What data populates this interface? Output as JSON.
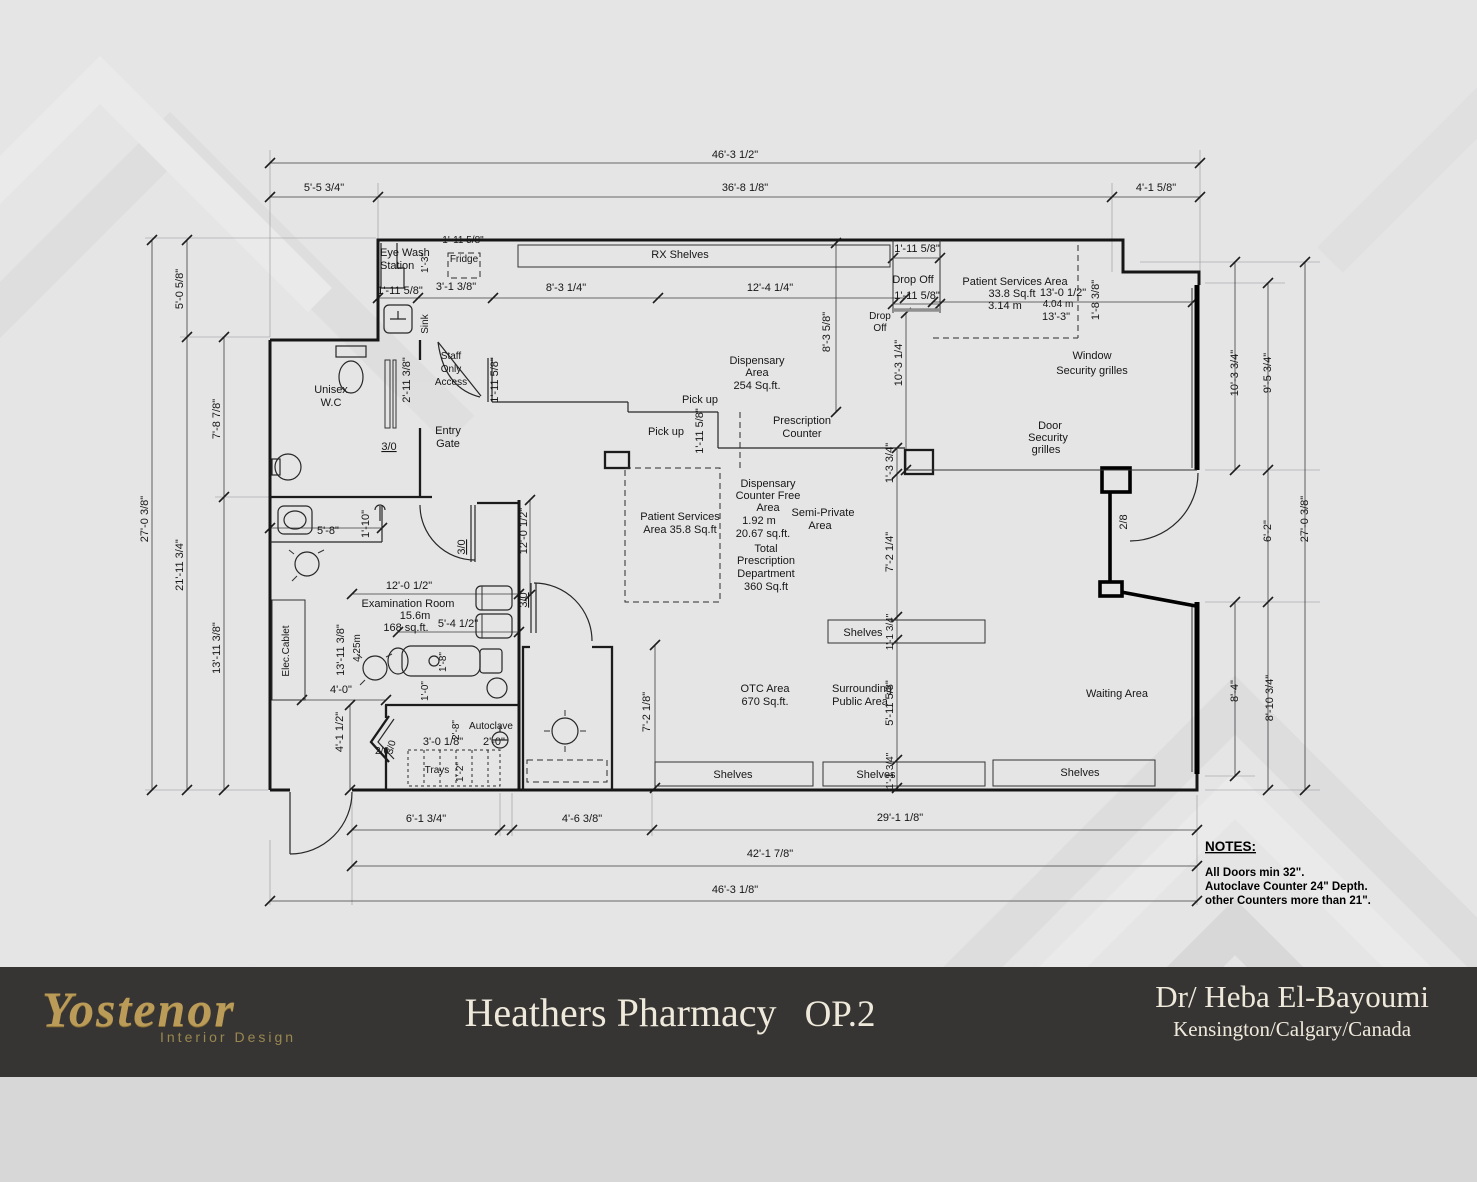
{
  "plan": {
    "dims": {
      "overall_top": "46'-3 1/2\"",
      "top_left": "5'-5 3/4\"",
      "top_mid": "36'-8 1/8\"",
      "top_right": "4'-1 5/8\"",
      "left_overall": "27'-0 3/8\"",
      "left_top": "5'-0 5/8\"",
      "left_mid": "21'-11 3/4\"",
      "wc_height": "7'-8 7/8\"",
      "exam_height": "13'-11 3/8\"",
      "exam_height_inner": "13'-11 3/8\"",
      "exam_height_m": "4.25m",
      "fridge_w": "1'-11 5/8\"",
      "eyewash_h": "1'-3\"",
      "row_a": "1'-11 5/8\"",
      "row_b": "3'-1 3/8\"",
      "row_c": "8'-3 1/4\"",
      "row_d": "12'-4 1/4\"",
      "wc_door_side": "2'-11 3/8\"",
      "staff_counter": "1'-11 5/8\"",
      "drop_w1": "1'-11 5/8\"",
      "drop_w2": "1'-11 5/8\"",
      "disp_depth": "8'-3 5/8\"",
      "mid_v": "10'-3 1/4\"",
      "ps_w": "13'-0 1/2\"",
      "ps_wm": "4.04 m",
      "ps_w2": "13'-3\"",
      "step_h": "1'-8 3/8\"",
      "pickup_w": "1'-11 5/8\"",
      "col_h": "1'-3 3/4\"",
      "semi_h": "7'-2 1/4\"",
      "win_h1": "10'-3 3/4\"",
      "win_h2": "9'-5 3/4\"",
      "right_overall": "27'-0 3/8\"",
      "door_h": "6'-2\"",
      "wait_h1": "8'-4\"",
      "wait_h2": "8'-10 3/4\"",
      "shelf_d1": "1'-1 3/4\"",
      "shelf_d2": "1'-1 3/4\"",
      "pub_h": "5'-11 5/8\"",
      "otc_v": "7'-2 1/8\"",
      "sink_w": "5'-8\"",
      "sink_d": "1'-10\"",
      "exam_w": "12'-0 1/2\"",
      "exam_w_v": "12'-0 1/2\"",
      "chair_w": "5'-4 1/2\"",
      "chair_d": "1'-8\"",
      "gap_1_0": "1'-0\"",
      "elec_w": "4'-0\"",
      "vest_h": "4'-1 1/2\"",
      "auto_d": "2'-8\"",
      "tray_w": "3'-0 1/8\"",
      "auto_w": "2'-0\"",
      "tray_d": "1'-2\"",
      "bot_a": "6'-1 3/4\"",
      "bot_b": "4'-6 3/8\"",
      "bot_c": "29'-1 1/8\"",
      "bot_d": "42'-1 7/8\"",
      "bot_e": "46'-3 1/8\""
    },
    "labels": {
      "eye_wash_1": "Eye Wash",
      "eye_wash_2": "Station",
      "fridge": "Fridge",
      "rx_shelves": "RX Shelves",
      "sink": "Sink",
      "staff_1": "Staff",
      "staff_2": "Only",
      "staff_3": "Access",
      "unisex_1": "Unisex",
      "unisex_2": "W.C",
      "entry_1": "Entry",
      "entry_2": "Gate",
      "drop_off": "Drop Off",
      "drop_1": "Drop",
      "drop_2": "Off",
      "psa_1": "Patient Services Area",
      "psa_2": "33.8 Sq.ft",
      "psa_3": "3.14 m",
      "window_1": "Window",
      "window_2": "Security grilles",
      "doorg_1": "Door",
      "doorg_2": "Security",
      "doorg_3": "grilles",
      "disp_1": "Dispensary",
      "disp_2": "Area",
      "disp_3": "254 Sq.ft.",
      "pickup_a": "Pick up",
      "pickup_b": "Pick up",
      "presc_1": "Prescription",
      "presc_2": "Counter",
      "psb_1": "Patient Services",
      "psb_2": "Area 35.8 Sq.ft",
      "dcf_1": "Dispensary",
      "dcf_2": "Counter Free",
      "dcf_3": "Area",
      "dcf_4": "1.92 m",
      "dcf_5": "20.67 sq.ft.",
      "semi_1": "Semi-Private",
      "semi_2": "Area",
      "tot_1": "Total",
      "tot_2": "Prescription",
      "tot_3": "Department",
      "tot_4": "360 Sq.ft",
      "exam_1": "Examination Room",
      "exam_2": "15.6m",
      "exam_3": "168 sq.ft.",
      "elec": "Elec.Cablet",
      "autoclave": "Autoclave",
      "trays": "Trays",
      "otc_1": "OTC Area",
      "otc_2": "670 Sq.ft.",
      "sur_1": "Surrounding",
      "sur_2": "Public Area",
      "waiting": "Waiting Area",
      "shelves_mid": "Shelves",
      "shelves_b1": "Shelves",
      "shelves_b2": "Shelves",
      "shelves_b3": "Shelves"
    },
    "doors": {
      "wc": "3/0",
      "exam": "3/0",
      "consult": "3/0",
      "vest_a": "2/6",
      "vest_b": "3/0",
      "right": "2/8"
    }
  },
  "notes": {
    "title": "NOTES:",
    "line1": "All Doors  min 32\".",
    "line2": "Autoclave Counter 24\" Depth.",
    "line3": "other Counters more than 21\"."
  },
  "footer": {
    "brand": "Yostenor",
    "brand_sub": "Interior Design",
    "title": "Heathers Pharmacy",
    "option": "OP.2",
    "client": "Dr/ Heba El-Bayoumi",
    "location": "Kensington/Calgary/Canada",
    "bar_color": "#363533",
    "gold": "#bb9b58"
  }
}
